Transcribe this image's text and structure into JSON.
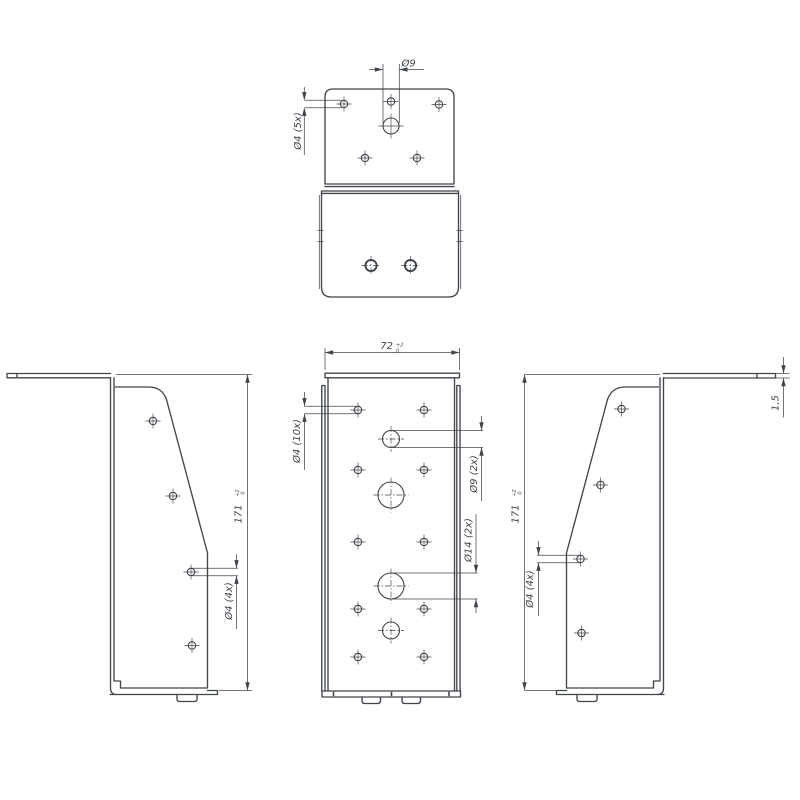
{
  "document": {
    "type": "technical-drawing",
    "part": "timber-connector-bracket",
    "background": "#ffffff"
  },
  "colors": {
    "line": "#40454b",
    "background": "#ffffff"
  },
  "views": {
    "top": {
      "name": "top view",
      "dim_d9": "Ø9",
      "dim_d4_5x": "Ø4 (5x)"
    },
    "front": {
      "name": "front view",
      "dim_width": "72",
      "dim_width_tol_up": "+2",
      "dim_width_tol_low": "0",
      "dim_d4_10x": "Ø4 (10x)",
      "dim_d9_2x": "Ø9 (2x)",
      "dim_d14_2x": "Ø14 (2x)"
    },
    "left": {
      "name": "left side view",
      "dim_height": "171",
      "dim_height_tol_up": "+2",
      "dim_height_tol_low": "0",
      "dim_d4_4x": "Ø4 (4x)"
    },
    "right": {
      "name": "right side view",
      "dim_height": "171",
      "dim_height_tol_up": "+2",
      "dim_height_tol_low": "0",
      "dim_d4_4x": "Ø4 (4x)",
      "dim_thickness": "1,5"
    }
  }
}
